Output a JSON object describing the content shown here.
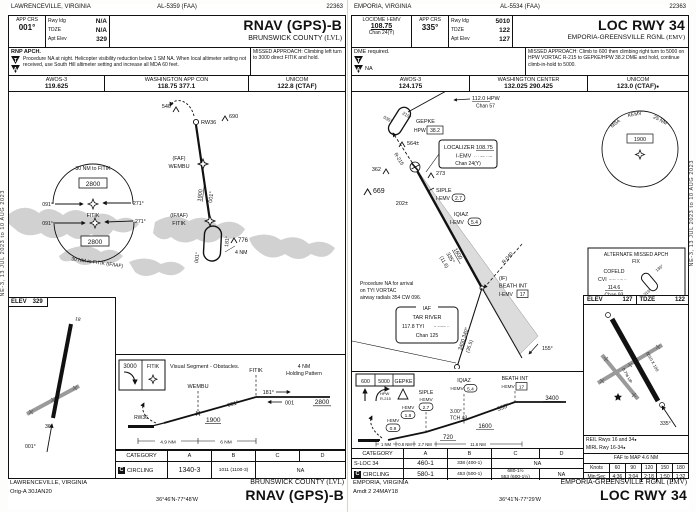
{
  "page": {
    "margin_text": "NE-3, 13 JUL 2023 to 10 AUG 2023"
  },
  "left": {
    "top": {
      "city": "LAWRENCEVILLE, VIRGINIA",
      "al": "AL-5359 (FAA)",
      "code": "22363"
    },
    "header": {
      "app_crs_label": "APP CRS",
      "app_crs": "001°",
      "rwy_ldg_label": "Rwy ldg",
      "rwy_ldg": "N/A",
      "tdze_label": "TDZE",
      "tdze": "N/A",
      "apt_elev_label": "Apt Elev",
      "apt_elev": "329",
      "title": "RNAV (GPS)-B",
      "airport": "BRUNSWICK COUNTY",
      "airport_id": "(LVL)"
    },
    "notes": {
      "rnp": "RNP APCH.",
      "t_symbol": "T",
      "a_symbol": "A",
      "note": "Procedure NA at night. Helicopter visibility reduction below 1 SM NA. When local altimeter setting not received, use South Hill altimeter setting and increase all MDA 60 feet.",
      "missed": "MISSED APPROACH: Climbing left turn to 3000 direct FITIK and hold."
    },
    "comms": {
      "c1_label": "AWOS-3",
      "c1": "119.625",
      "c2_label": "WASHINGTON APP CON",
      "c2": "118.75  377.1",
      "c3_label": "UNICOM",
      "c3": "122.8 (CTAF)"
    },
    "plan": {
      "taa_top_arc": "30 NM to FITIK",
      "taa_top_alt": "2800",
      "taa_top_l": "091°",
      "taa_top_r": "271°",
      "fitik_mid": "FITIK",
      "taa_bot_l": "091°",
      "taa_bot_r": "271°",
      "taa_bot_alt": "2800",
      "taa_bot_arc": "30 NM to FITIK (IF/IAF)",
      "ob_540": "540",
      "rw36": "RW36",
      "ob_690": "690",
      "faf_tag": "(FAF)",
      "faf_name": "WEMBU",
      "seg_alt": "1900",
      "seg_crs": "001°",
      "if_tag": "(IF/IAF)",
      "if_name": "FITIK",
      "hold_out": "181°",
      "hold_in": "001°",
      "ob_776": "776",
      "hold_len": "4 NM"
    },
    "sketch": {
      "elev_label": "ELEV",
      "elev": "329",
      "rwy_a": "18",
      "rwy_b": "36",
      "final_crs": "001°"
    },
    "profile": {
      "ma_alt": "3000",
      "ma_fix": "FITIK",
      "visual_note": "Visual Segment - Obstacles.",
      "fix1": "WEMBU",
      "fix2": "FITIK",
      "hold_l1": "4 NM",
      "hold_l2": "Holding Pattern",
      "rw": "RW36",
      "crs": "001°",
      "alt1": "1900",
      "hold_out": "181°",
      "hold_in": "001",
      "hold_alt": "2800",
      "d1": "4.9 NM",
      "d2": "6 NM"
    },
    "minima": {
      "cat_label": "CATEGORY",
      "cat_a": "A",
      "cat_b": "B",
      "cat_c": "C",
      "cat_d": "D",
      "row1_icon": "C",
      "row1_label": "CIRCLING",
      "row1_ab1": "1340-3",
      "row1_ab2": "1011 (1100-3)",
      "row1_cd": "NA"
    },
    "footer": {
      "city": "LAWRENCEVILLE, VIRGINIA",
      "amdt": "Orig-A  30JAN20",
      "coords": "36°46'N-77°48'W",
      "airport": "BRUNSWICK COUNTY",
      "airport_id": "(LVL)",
      "title": "RNAV (GPS)-B"
    }
  },
  "right": {
    "top": {
      "city": "EMPORIA, VIRGINIA",
      "al": "AL-5534 (FAA)",
      "code": "22363"
    },
    "header": {
      "loc_label": "LOC/DME I-EMV",
      "loc_freq": "108.75",
      "loc_chan": "Chan 24(Y)",
      "app_crs_label": "APP CRS",
      "app_crs": "335°",
      "rwy_ldg_label": "Rwy ldg",
      "rwy_ldg": "5010",
      "tdze_label": "TDZE",
      "tdze": "122",
      "apt_elev_label": "Apt Elev",
      "apt_elev": "127",
      "title": "LOC RWY 34",
      "airport": "EMPORIA-GREENSVILLE RGNL",
      "airport_id": "(EMV)"
    },
    "notes": {
      "dme": "DME required.",
      "t_symbol": "T",
      "a_symbol": "A",
      "na": "NA",
      "missed": "MISSED APPROACH: Climb to 600 then climbing right turn to 5000 on HPW VORTAC R-215 to GEPKE/HPW 38.2 DME and hold, continue climb-in-hold to 5000."
    },
    "comms": {
      "c1_label": "AWOS-3",
      "c1": "124.175",
      "c2_label": "WASHINGTON CENTER",
      "c2": "132.025  290.425",
      "c3_label": "UNICOM",
      "c3": "123.0 (CTAF)",
      "c3_icon": "●"
    },
    "plan": {
      "vor_freq": "112.0 HPW",
      "vor_chan": "Chan 57",
      "hold1_in": "035°",
      "hold1_out": "215°",
      "gepke": "GEPKE",
      "gepke_vor": "HPW",
      "gepke_dme": "38.2",
      "r215": "R-215",
      "ob_564": "564±",
      "ob_362": "362",
      "ob_669": "669",
      "ob_273": "273",
      "ob_202": "202±",
      "locbox_l1a": "LOCALIZER",
      "locbox_l1b": "108.75",
      "locbox_id": "I-EMV",
      "locbox_morse": "·· · −− ···−",
      "locbox_chan": "Chan 24(Y)",
      "siple": "SIPLE",
      "siple_id": "I-EMV",
      "siple_dme": "2.7",
      "iqiaz": "IQIAZ",
      "iqiaz_id": "I-EMV",
      "iqiaz_dme": "5.4",
      "seg_alt": "1600",
      "seg_crs": "335°",
      "seg_dist": "(11.6)",
      "r040": "R-040",
      "if_tag": "(IF)",
      "beath": "BEATH INT",
      "beath_id": "I-EMV",
      "beath_dme": "17",
      "note_l1": "Procedure NA for arrival",
      "note_l2": "on TYI VORTAC",
      "note_l3": "airway radials 354 CW 096.",
      "iaf_tag": "IAF",
      "tar": "TAR RIVER",
      "tyi": "117.8  TYI",
      "tyi_morse": "− −·−− ··",
      "tyi_chan": "Chan 125",
      "tar_alt": "3400  340°",
      "tar_dist": "(35.5)",
      "out_crs": "155°",
      "msa_1": "MSA",
      "msa_2": "KEMV",
      "msa_3": "25 NM",
      "msa_alt": "1900",
      "amaf_l1": "ALTERNATE MISSED APCH",
      "amaf_l2": "FIX",
      "cofeld": "COFELD",
      "cvi": "CVI",
      "cvi_morse": "−·−· ···− ··",
      "cvi_freq": "114.6",
      "cvi_chan": "Chan 93",
      "hold2_in": "136°",
      "hold2_out": "316°"
    },
    "sketch": {
      "elev_label": "ELEV",
      "elev": "127",
      "tdze_label": "TDZE",
      "tdze": "122",
      "rwy_dim": "5010 X 100",
      "grade": "0.7% UP",
      "final_crs": "335°"
    },
    "profile": {
      "ma1": "600",
      "ma2": "5000",
      "ma3": "GEPKE",
      "ma_vor": "HPW",
      "ma_r": "R-215",
      "siple": "SIPLE",
      "siple_id": "I-EMV",
      "siple_dme": "2.7",
      "iqiaz": "IQIAZ",
      "iqiaz_id": "I-EMV",
      "iqiaz_dme": "5.4",
      "beath": "BEATH INT",
      "beath_id": "I-EMV",
      "beath_dme": "17",
      "f18_id": "I-EMV",
      "f18": "1.8",
      "f09_id": "I-EMV",
      "f09": "0.9",
      "alt_720": "720",
      "alt_1600": "1600",
      "alt_3400": "3400",
      "crs": "335°",
      "gs": "3.00°",
      "tch": "TCH 43",
      "d1": "1 NM",
      "d2": "0.8 NM",
      "d3": "2.7 NM",
      "d4": "11.6 NM"
    },
    "minima": {
      "cat_label": "CATEGORY",
      "cat_a": "A",
      "cat_b": "B",
      "cat_c": "C",
      "cat_d": "D",
      "row1_label": "S-LOC 34",
      "row1_ab1": "460-1",
      "row1_ab2": "338 (400-1)",
      "row1_cd": "NA",
      "row2_icon": "C",
      "row2_label": "CIRCLING",
      "row2_ab1": "580-1",
      "row2_ab2": "453 (500-1)",
      "row2_c1": "680-1½",
      "row2_c2": "553 (600-1½)",
      "row2_d": "NA"
    },
    "aux": {
      "reil": "REIL Rwys 16 and 34",
      "reil_icon": "●",
      "mirl": "MIRL Rwy 16-34",
      "mirl_icon": "●",
      "faf_map": "FAF to MAP  4.6 NM",
      "knots_label": "Knots",
      "knots": [
        "60",
        "90",
        "120",
        "150",
        "180"
      ],
      "minsec_label": "Min:Sec",
      "minsec": [
        "4:36",
        "3:04",
        "2:18",
        "1:50",
        "1:32"
      ]
    },
    "footer": {
      "city": "EMPORIA, VIRGINIA",
      "amdt": "Amdt 2  24MAY18",
      "coords": "36°41'N-77°29'W",
      "airport": "EMPORIA-GREENSVILLE RGNL",
      "airport_id": "(EMV)",
      "title": "LOC RWY 34"
    }
  }
}
